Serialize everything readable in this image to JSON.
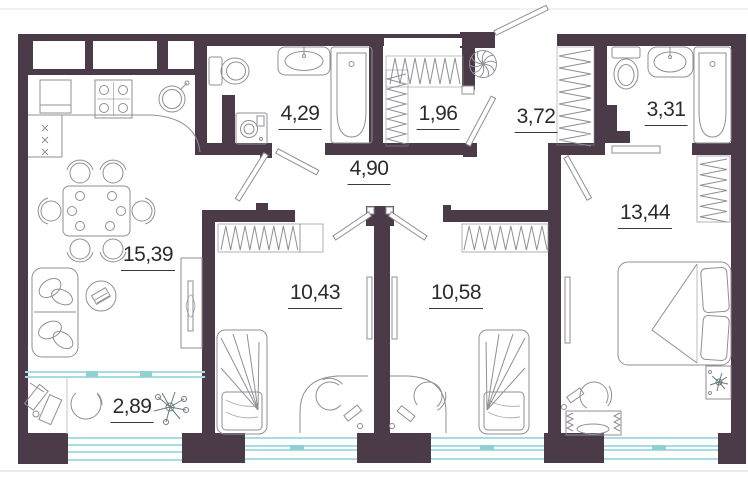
{
  "plan_title": "apartment-floor-plan",
  "rooms": [
    {
      "id": "kitchen-living",
      "area": "15,39"
    },
    {
      "id": "bathroom-1",
      "area": "4,29"
    },
    {
      "id": "storage",
      "area": "1,96"
    },
    {
      "id": "hallway",
      "area": "4,90"
    },
    {
      "id": "corridor",
      "area": "3,72"
    },
    {
      "id": "bathroom-2",
      "area": "3,31"
    },
    {
      "id": "bedroom-large",
      "area": "13,44"
    },
    {
      "id": "bedroom-1",
      "area": "10,43"
    },
    {
      "id": "bedroom-2",
      "area": "10,58"
    },
    {
      "id": "balcony",
      "area": "2,89"
    }
  ],
  "colors": {
    "wall": "#4b3b49",
    "glass": "#a7dce0",
    "glass_accent": "#8fd0d4",
    "furniture": "#8f8f96",
    "label": "#2b2b2b"
  }
}
